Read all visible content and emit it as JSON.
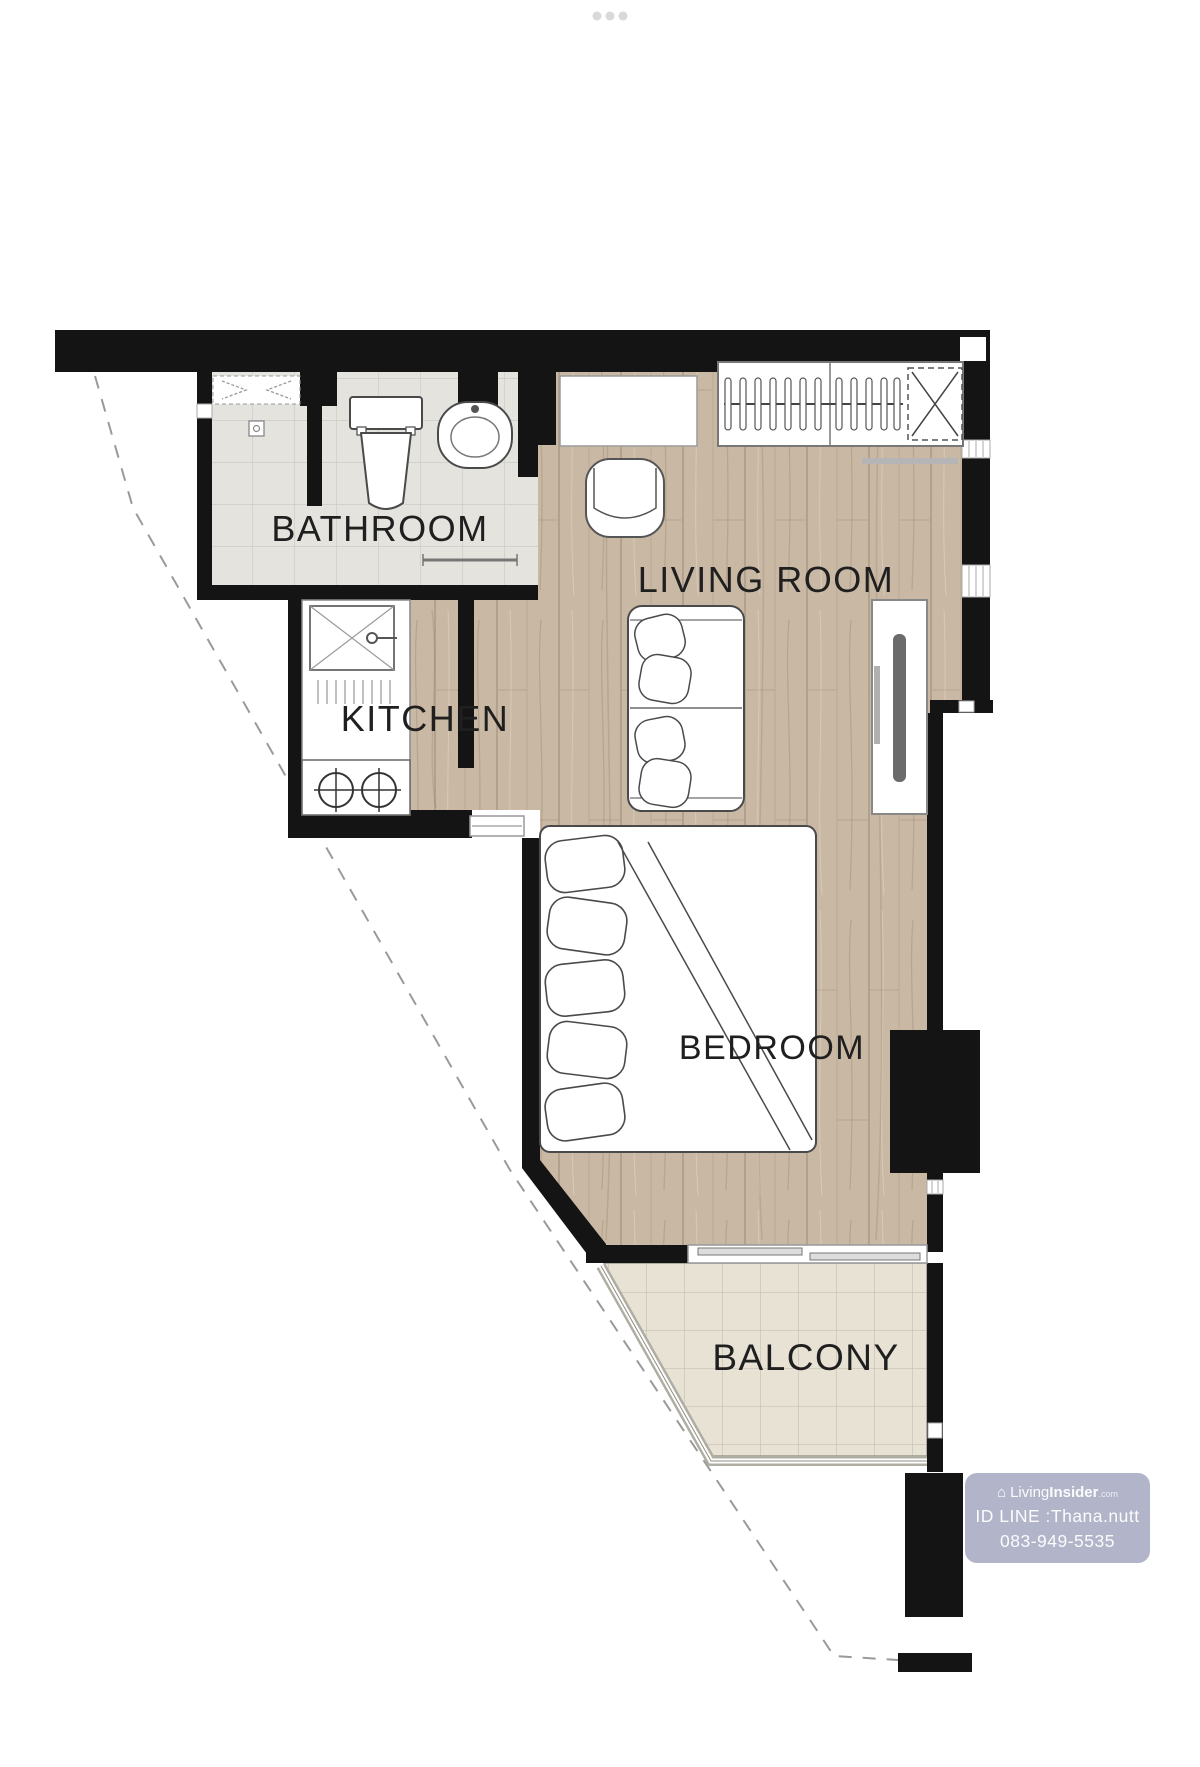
{
  "page": {
    "bg_color": "#ffffff",
    "carousel_dots": 3,
    "dots_color": "#d9d9d9"
  },
  "plan": {
    "labels": {
      "bathroom": "BATHROOM",
      "kitchen": "KITCHEN",
      "living_room": "LIVING ROOM",
      "bedroom": "BEDROOM",
      "balcony": "BALCONY"
    },
    "colors": {
      "wall": "#141414",
      "wood_floor": "#c9b8a4",
      "wood_line": "#b2a18c",
      "bath_tile": "#e4e3de",
      "bath_tile_line": "#cdccc6",
      "balcony_tile": "#e7e2d4",
      "balcony_tile_line": "#c6c1b2",
      "furniture_outline": "#4a4a4a",
      "label_color": "#1f1f1f",
      "boundary_dash": "#9a9a9a",
      "watermark_bg": "#a4a8bf"
    }
  },
  "watermark": {
    "house_icon": "⌂",
    "brand_light": "Living",
    "brand_bold": "Insider",
    "brand_tld": ".com",
    "id_line": "ID LINE :Thana.nutt",
    "phone": "083-949-5535"
  }
}
